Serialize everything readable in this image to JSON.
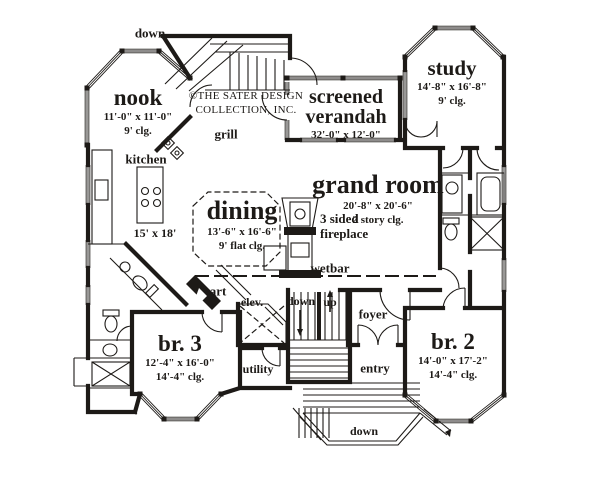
{
  "copyright": {
    "line1": "©THE SATER DESIGN",
    "line2": "COLLECTION, INC."
  },
  "rooms": {
    "nook": {
      "name": "nook",
      "dims": "11'-0\" x 11'-0\"",
      "ceiling": "9' clg."
    },
    "kitchen": {
      "name": "kitchen",
      "dims": "15' x 18'"
    },
    "study": {
      "name": "study",
      "dims": "14'-8\" x 16'-8\"",
      "ceiling": "9' clg."
    },
    "verandah": {
      "name_line1": "screened",
      "name_line2": "verandah",
      "dims": "32'-0\" x 12'-0\""
    },
    "grand_room": {
      "name": "grand room",
      "dims": "20'-8\" x 20'-6\"",
      "ceiling": "2 story clg."
    },
    "dining": {
      "name": "dining",
      "dims": "13'-6\" x 16'-6\"",
      "ceiling": "9' flat clg."
    },
    "br3": {
      "name": "br. 3",
      "dims": "12'-4\" x 16'-0\"",
      "ceiling": "14'-4\" clg."
    },
    "br2": {
      "name": "br. 2",
      "dims": "14'-0\" x 17'-2\"",
      "ceiling": "14'-4\" clg."
    },
    "foyer": {
      "name": "foyer"
    },
    "entry": {
      "name": "entry"
    },
    "utility": {
      "name": "utility"
    }
  },
  "labels": {
    "down_top": "down",
    "down_stairs": "down",
    "up_stairs": "up",
    "down_entry": "down",
    "grill": "grill",
    "wetbar": "wetbar",
    "art": "art",
    "elevator": "elev.",
    "fireplace_line1": "3 sided",
    "fireplace_line2": "fireplace"
  },
  "colors": {
    "ink": "#1d1a17",
    "paper": "#ffffff"
  }
}
